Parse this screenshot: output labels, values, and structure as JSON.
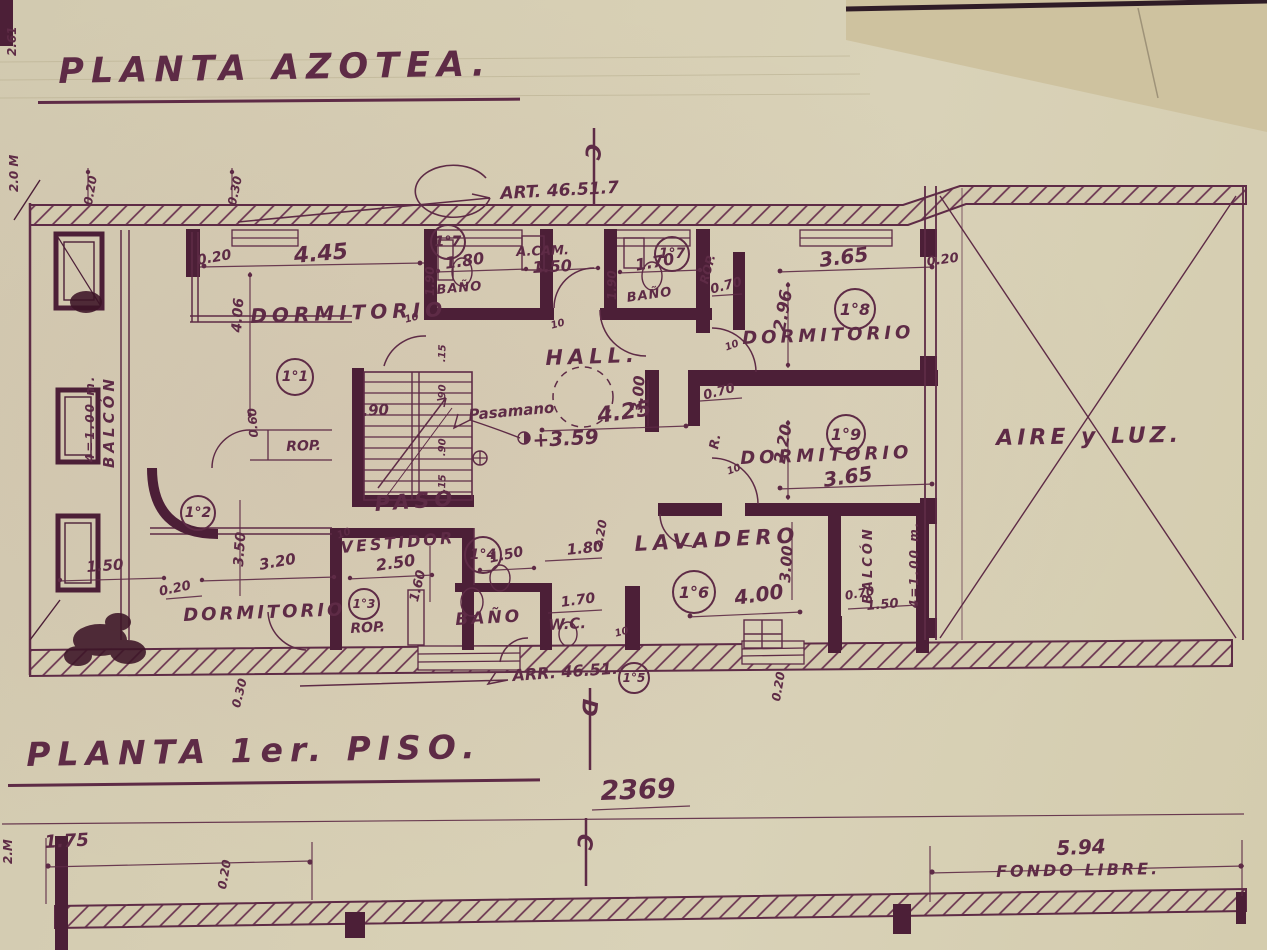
{
  "colors": {
    "ink": "#5e2b46",
    "wall": "#4c1f37",
    "paper": "#d7cfb4",
    "paper_corner": "#cec29f"
  },
  "titles": {
    "top": "PLANTA AZOTEA.",
    "bottom": "PLANTA 1er. PISO."
  },
  "section_markers": {
    "top": "C",
    "middle": "D",
    "bottom": "C"
  },
  "room_labels": [
    {
      "t": "DORMITORIO"
    },
    {
      "t": "DORMITORIO"
    },
    {
      "t": "DORMITORIO"
    },
    {
      "t": "DORMITORIO"
    },
    {
      "t": "HALL."
    },
    {
      "t": "PASO"
    },
    {
      "t": "VESTIDOR"
    },
    {
      "t": "LAVADERO"
    },
    {
      "t": "BAÑO"
    },
    {
      "t": "BAÑO"
    },
    {
      "t": "BAÑO"
    },
    {
      "t": "W.C."
    },
    {
      "t": "A.CAM."
    },
    {
      "t": "AIRE y LUZ."
    },
    {
      "t": "BALCÓN"
    },
    {
      "t": "4=1.00 m."
    },
    {
      "t": "BALCÓN"
    },
    {
      "t": "4=1.00 m."
    },
    {
      "t": "ROP."
    },
    {
      "t": "ROP."
    },
    {
      "t": "ROP."
    },
    {
      "t": "R."
    }
  ],
  "room_numbers": [
    {
      "n": "1°1"
    },
    {
      "n": "1°2"
    },
    {
      "n": "1°3"
    },
    {
      "n": "1°4"
    },
    {
      "n": "1°5"
    },
    {
      "n": "1°6"
    },
    {
      "n": "1°7"
    },
    {
      "n": "1°7"
    },
    {
      "n": "1°8"
    },
    {
      "n": "1°9"
    }
  ],
  "dimensions": [
    {
      "t": "4.45"
    },
    {
      "t": "0.20"
    },
    {
      "t": "4.06"
    },
    {
      "t": "0.60"
    },
    {
      "t": "1.50"
    },
    {
      "t": "1.80"
    },
    {
      "t": "1.90"
    },
    {
      "t": "1.70"
    },
    {
      "t": "1.90"
    },
    {
      "t": "0.70"
    },
    {
      "t": "3.65"
    },
    {
      "t": "2.96"
    },
    {
      "t": "0.20"
    },
    {
      "t": "3.65"
    },
    {
      "t": "2.20"
    },
    {
      "t": "0.70"
    },
    {
      "t": "3.00"
    },
    {
      "t": "4.25"
    },
    {
      "t": ".90"
    },
    {
      "t": ".15"
    },
    {
      "t": ".90"
    },
    {
      "t": ".90"
    },
    {
      "t": ".15"
    },
    {
      "t": "3.50"
    },
    {
      "t": "1.50"
    },
    {
      "t": "0.20"
    },
    {
      "t": "3.20"
    },
    {
      "t": "2.50"
    },
    {
      "t": "1.60"
    },
    {
      "t": "1.50"
    },
    {
      "t": "1.70"
    },
    {
      "t": "1.80"
    },
    {
      "t": "4.00"
    },
    {
      "t": "3.00"
    },
    {
      "t": "2.20"
    },
    {
      "t": "0.70"
    },
    {
      "t": "1.50"
    },
    {
      "t": "2369"
    },
    {
      "t": "1.75"
    },
    {
      "t": "0.20"
    },
    {
      "t": "5.94"
    },
    {
      "t": "0.20"
    },
    {
      "t": "0.30"
    },
    {
      "t": "0.30"
    },
    {
      "t": "0.20"
    },
    {
      "t": "10"
    },
    {
      "t": "10"
    },
    {
      "t": "10"
    },
    {
      "t": "10"
    },
    {
      "t": "10"
    },
    {
      "t": "10"
    },
    {
      "t": "2.61"
    },
    {
      "t": "2.0 M"
    },
    {
      "t": "2.M"
    }
  ],
  "annotations": [
    {
      "t": "ART. 46.51.7"
    },
    {
      "t": "ARR. 46.51."
    },
    {
      "t": "Pasamano"
    },
    {
      "t": "+3.59"
    },
    {
      "t": "FONDO LIBRE."
    }
  ]
}
